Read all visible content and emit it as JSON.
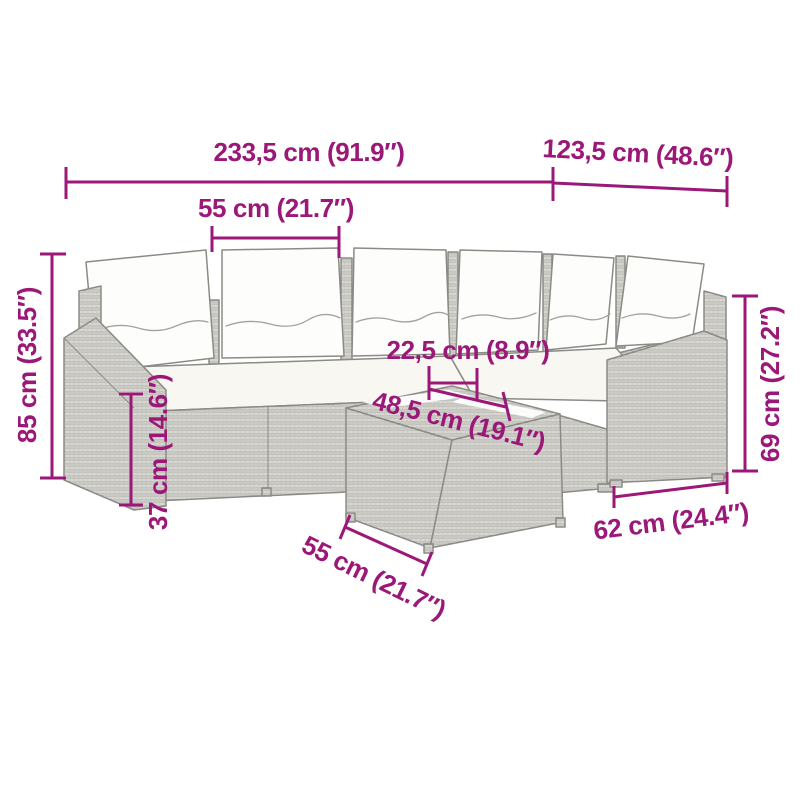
{
  "style": {
    "background": "#ffffff",
    "dimension_color": "#9B1878",
    "line_art_color": "#8b8b86",
    "rattan_fill": "#e7e6e2",
    "cushion_fill": "#fdfdfb"
  },
  "illustration": {
    "subject": "grey poly rattan corner sofa set with white back and seat cushions and coffee table",
    "back_cushion_count": 6
  },
  "dimensions": [
    {
      "id": "overall-width",
      "label": "233,5 cm (91.9″)"
    },
    {
      "id": "corner-depth",
      "label": "123,5 cm (48.6″)"
    },
    {
      "id": "seat-module-width",
      "label": "55 cm (21.7″)"
    },
    {
      "id": "overall-height",
      "label": "85 cm (33.5″)"
    },
    {
      "id": "seat-height",
      "label": "37 cm (14.6″)"
    },
    {
      "id": "table-top-depth",
      "label": "22,5 cm (8.9″)"
    },
    {
      "id": "table-top-length",
      "label": "48,5 cm (19.1″)"
    },
    {
      "id": "table-width",
      "label": "55 cm (21.7″)"
    },
    {
      "id": "end-module-width",
      "label": "62 cm (24.4″)"
    },
    {
      "id": "back-height",
      "label": "69 cm (27.2″)"
    }
  ]
}
